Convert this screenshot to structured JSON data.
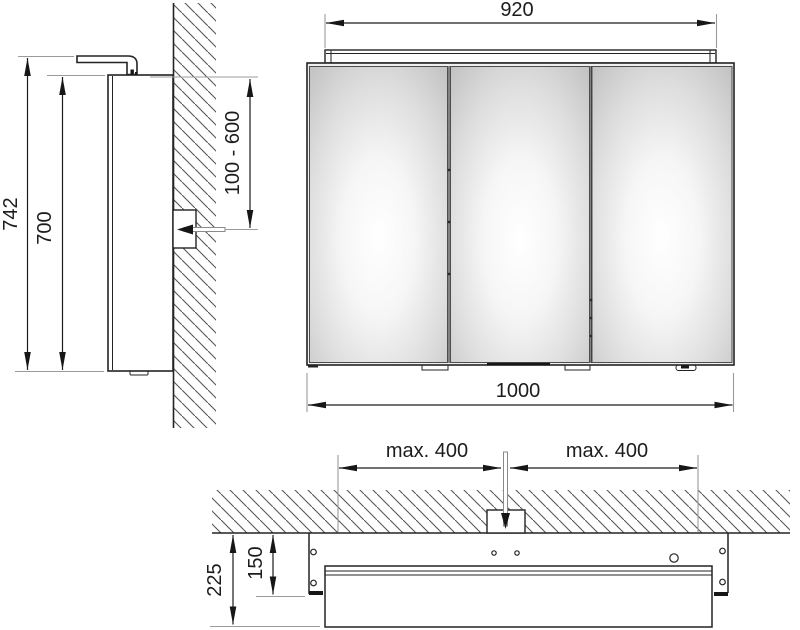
{
  "drawing": {
    "type": "technical-dimension-drawing",
    "subject": "mirror-cabinet-with-top-light",
    "colors": {
      "line": "#1c1c1c",
      "extension_line": "#9b9b9b",
      "hatch": "#575757",
      "mirror_edge": "#c3c3c3",
      "background": "#ffffff"
    },
    "side_view": {
      "total_height": "742",
      "carcase_height": "700",
      "outlet_height_range": "100 - 600"
    },
    "front_view": {
      "light_width": "920",
      "cabinet_width": "1000"
    },
    "plan_view": {
      "outlet_offset_left": "max. 400",
      "outlet_offset_right": "max. 400",
      "total_depth": "225",
      "carcase_depth": "150"
    }
  }
}
